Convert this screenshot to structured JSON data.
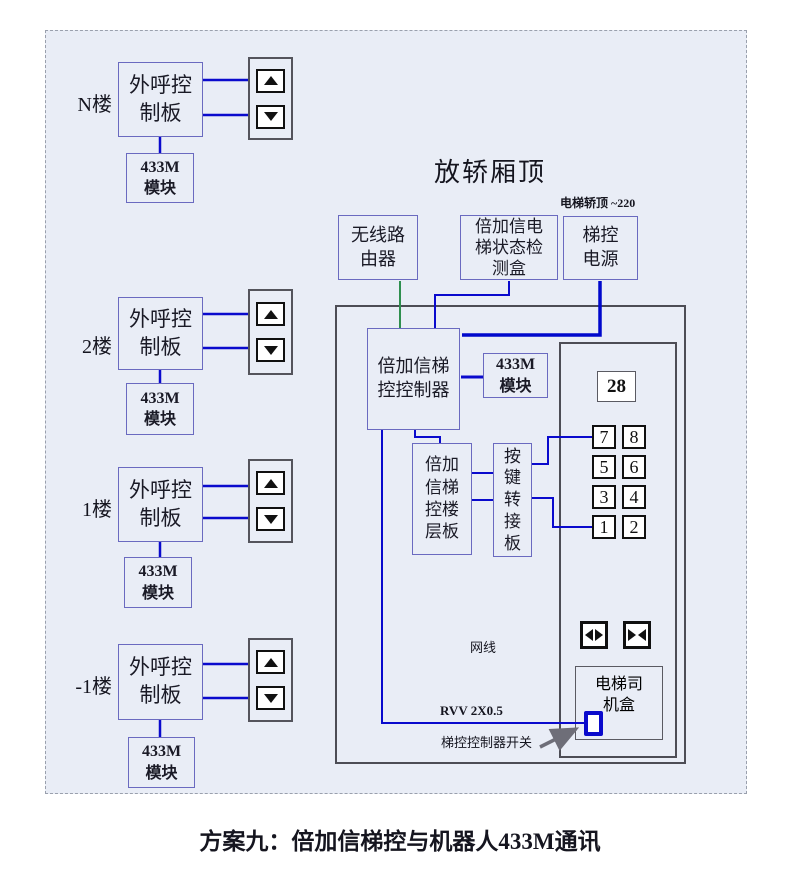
{
  "caption": "方案九：倍加信梯控与机器人433M通讯",
  "car_top": {
    "title": "放轿厢顶",
    "power_note": "电梯轿顶 ~220",
    "router": "无线路由器",
    "detector": "倍加信电梯状态检测盒",
    "power": "梯控电源"
  },
  "cabinet": {
    "controller": "倍加信梯控控制器",
    "module_433m": "433M 模块",
    "floor_board": "倍加信梯控楼层板",
    "key_adapter": "按键转接板",
    "driver_box": "电梯司机盒",
    "network_label": "网线",
    "rvv_label": "RVV 2X0.5",
    "switch_label": "梯控控制器开关"
  },
  "panel": {
    "display": "28",
    "buttons": [
      "7",
      "8",
      "5",
      "6",
      "3",
      "4",
      "1",
      "2"
    ],
    "door_open_icon": "door-open",
    "door_close_icon": "door-close"
  },
  "floors": [
    {
      "label": "N楼",
      "board": "外呼控制板",
      "module": "433M 模块"
    },
    {
      "label": "2楼",
      "board": "外呼控制板",
      "module": "433M 模块"
    },
    {
      "label": "1楼",
      "board": "外呼控制板",
      "module": "433M 模块"
    },
    {
      "label": "-1楼",
      "board": "外呼控制板",
      "module": "433M 模块"
    }
  ],
  "icons": {
    "up": "up-arrow",
    "down": "down-arrow",
    "switch": "toggle-switch",
    "pointer": "arrow-pointer"
  },
  "colors": {
    "wire_blue": "#0a0acd",
    "wire_green": "#2f8f4f",
    "box_border": "#6a6ac0",
    "cabinet_border": "#4d4d55",
    "background": "#e9edf6"
  }
}
